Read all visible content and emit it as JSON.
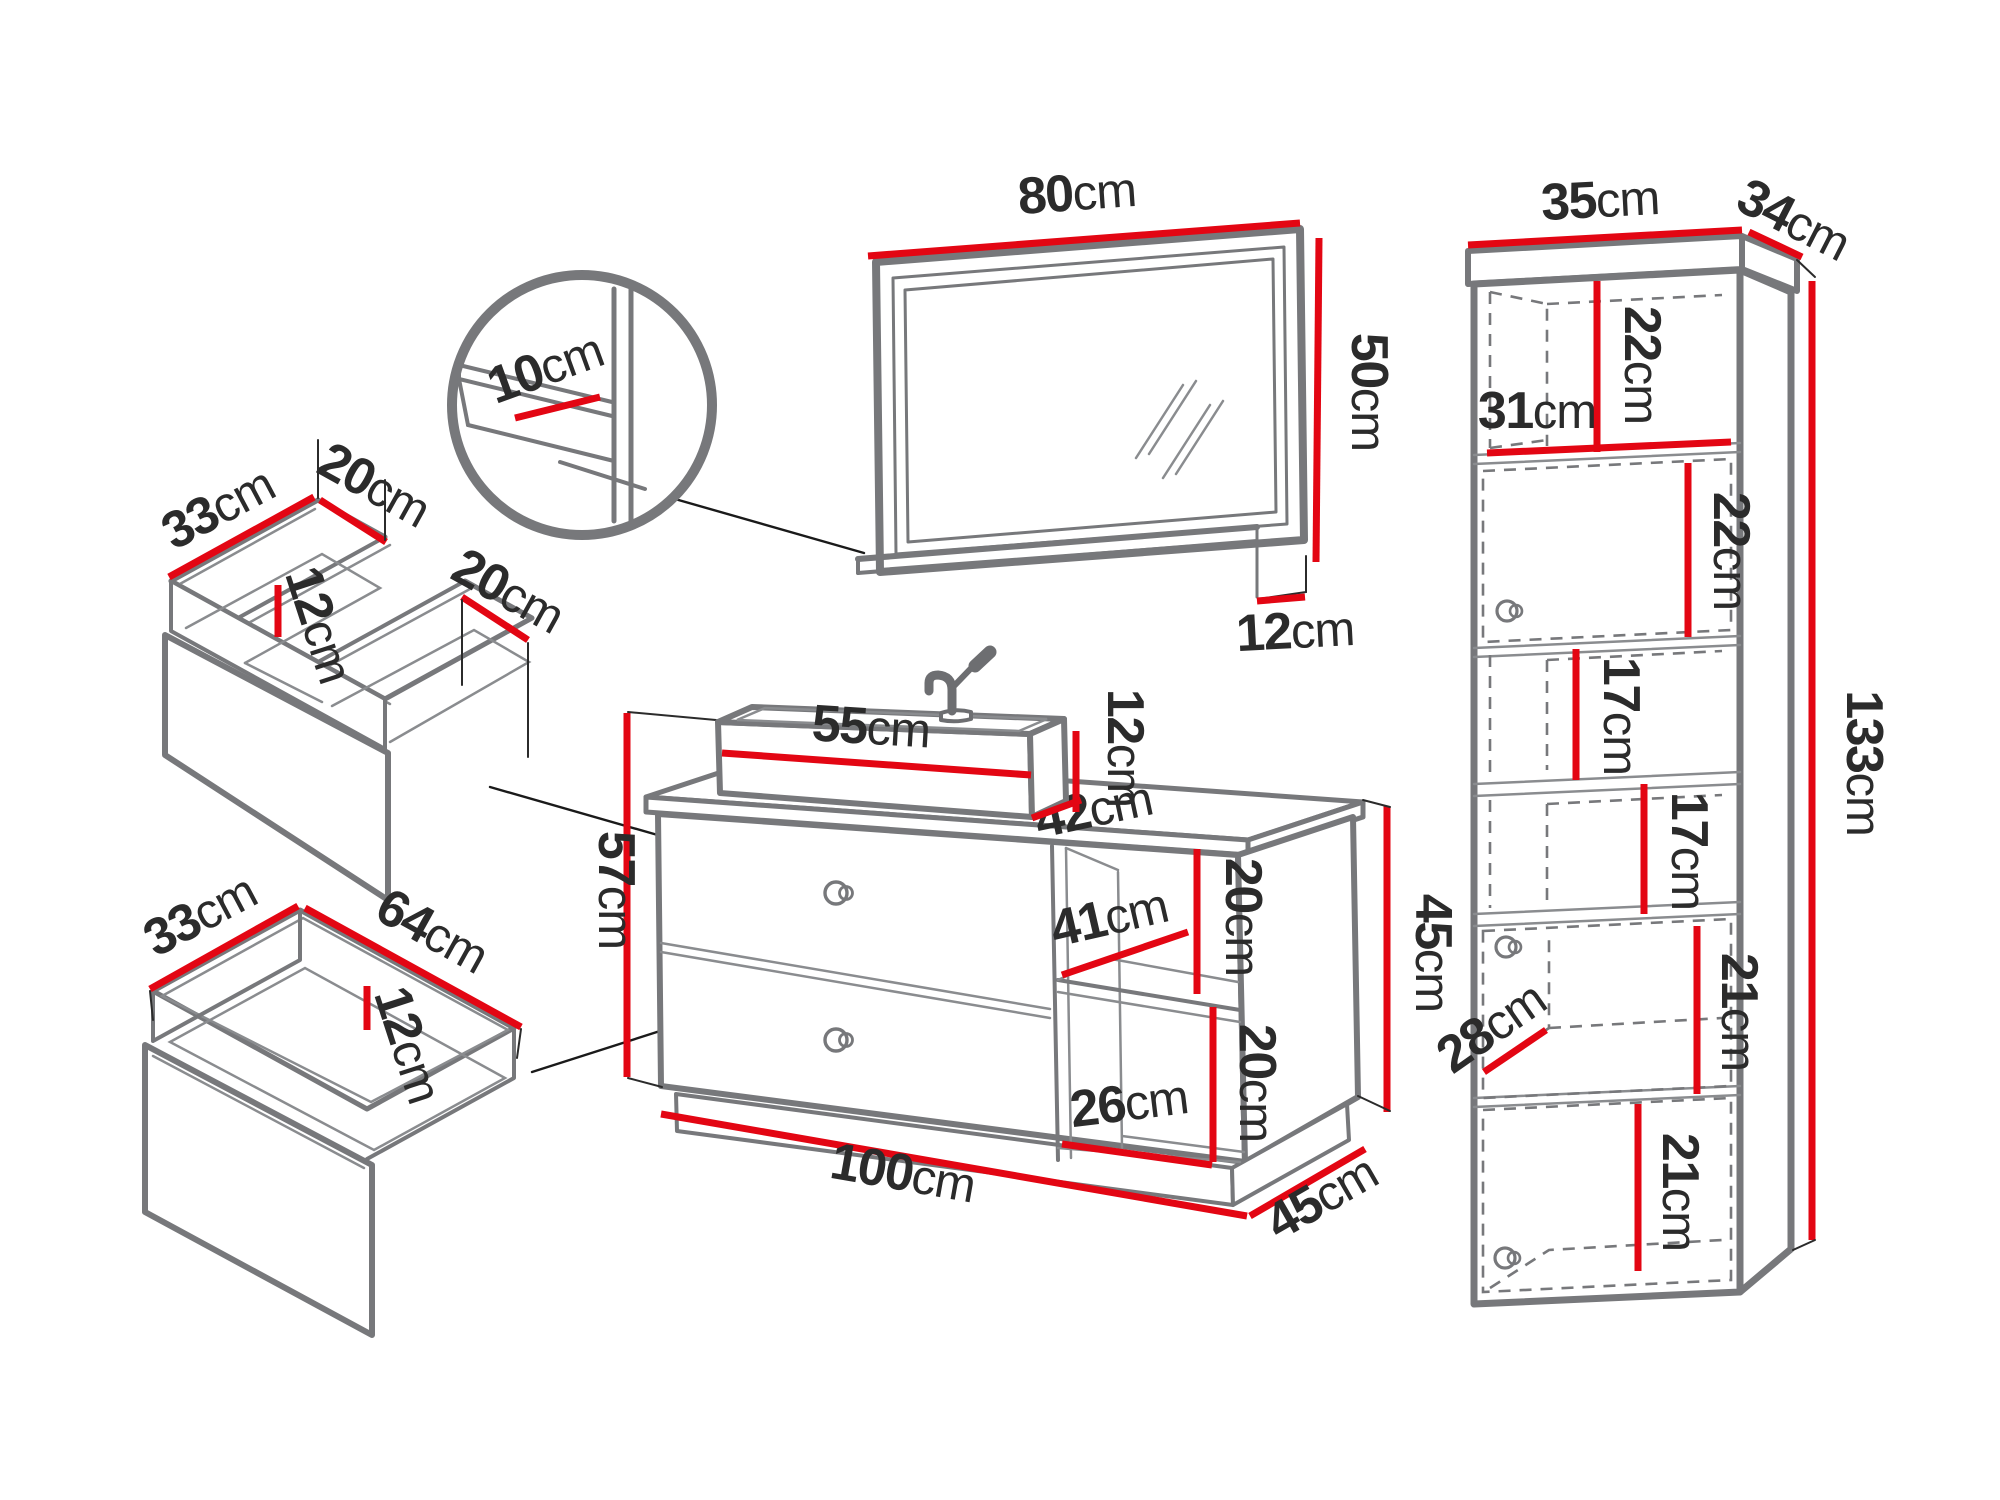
{
  "style": {
    "accent_color": "#e30613",
    "furniture_outline_color": "#77787b",
    "text_color": "#2b2b2b",
    "background": "#ffffff"
  },
  "diagram": {
    "kind": "bathroom-furniture-set-dimension-drawing",
    "units": "cm",
    "pieces": [
      "mirror-with-shelf",
      "shelf-detail-callout",
      "tall-side-cabinet",
      "vanity-with-basin",
      "top-drawer-insert",
      "bottom-drawer-insert"
    ]
  },
  "dims": {
    "mirror_w": {
      "v": "80",
      "u": "cm"
    },
    "mirror_h": {
      "v": "50",
      "u": "cm"
    },
    "mirror_shelf": {
      "v": "12",
      "u": "cm"
    },
    "detail_shelf": {
      "v": "10",
      "u": "cm"
    },
    "cab_top_w": {
      "v": "35",
      "u": "cm"
    },
    "cab_top_d": {
      "v": "34",
      "u": "cm"
    },
    "cab_open1_h": {
      "v": "22",
      "u": "cm"
    },
    "cab_inner_w": {
      "v": "31",
      "u": "cm"
    },
    "cab_door1_h": {
      "v": "22",
      "u": "cm"
    },
    "cab_shelf1_h": {
      "v": "17",
      "u": "cm"
    },
    "cab_shelf2_h": {
      "v": "17",
      "u": "cm"
    },
    "cab_total_h": {
      "v": "133",
      "u": "cm"
    },
    "cab_door2_h": {
      "v": "21",
      "u": "cm"
    },
    "cab_d": {
      "v": "28",
      "u": "cm"
    },
    "cab_door3_h": {
      "v": "21",
      "u": "cm"
    },
    "basin_w": {
      "v": "55",
      "u": "cm"
    },
    "basin_h": {
      "v": "12",
      "u": "cm"
    },
    "vanity_top_d": {
      "v": "42",
      "u": "cm"
    },
    "vanity_h": {
      "v": "57",
      "u": "cm"
    },
    "niche_w": {
      "v": "41",
      "u": "cm"
    },
    "niche1_h": {
      "v": "20",
      "u": "cm"
    },
    "vanity_side_h": {
      "v": "45",
      "u": "cm"
    },
    "niche2_h": {
      "v": "20",
      "u": "cm"
    },
    "niche_bot_w": {
      "v": "26",
      "u": "cm"
    },
    "vanity_w": {
      "v": "100",
      "u": "cm"
    },
    "vanity_d": {
      "v": "45",
      "u": "cm"
    },
    "tdrawer_d": {
      "v": "33",
      "u": "cm"
    },
    "tdrawer_lw": {
      "v": "20",
      "u": "cm"
    },
    "tdrawer_h": {
      "v": "12",
      "u": "cm"
    },
    "tdrawer_rw": {
      "v": "20",
      "u": "cm"
    },
    "bdrawer_d": {
      "v": "33",
      "u": "cm"
    },
    "bdrawer_w": {
      "v": "64",
      "u": "cm"
    },
    "bdrawer_h": {
      "v": "12",
      "u": "cm"
    }
  }
}
